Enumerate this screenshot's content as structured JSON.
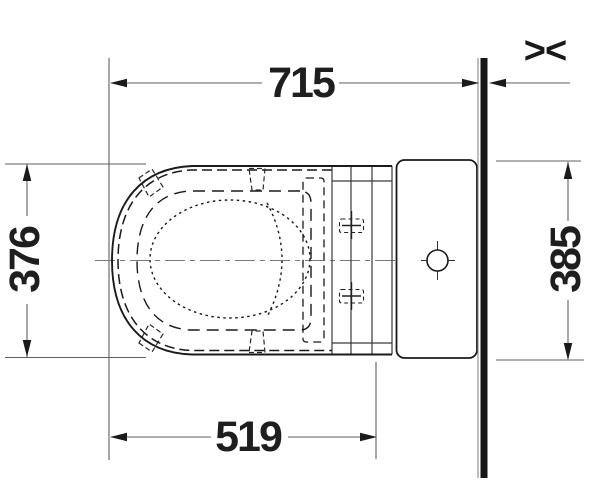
{
  "drawing": {
    "type": "technical-top-view",
    "subject": "toilet-with-cistern",
    "dimensions": {
      "overall_depth_to_wall": "715",
      "bowl_front_to_fixing": "519",
      "seat_width": "376",
      "cistern_width": "385"
    },
    "icons": {
      "variable_distance": "><"
    },
    "colors": {
      "object_line": "#1a1a1a",
      "detail_line": "#3a3a3a",
      "dimension_line": "#5f5f5f",
      "center_line": "#7a7a7a",
      "wall_bar": "#161616",
      "background": "#ffffff"
    }
  }
}
